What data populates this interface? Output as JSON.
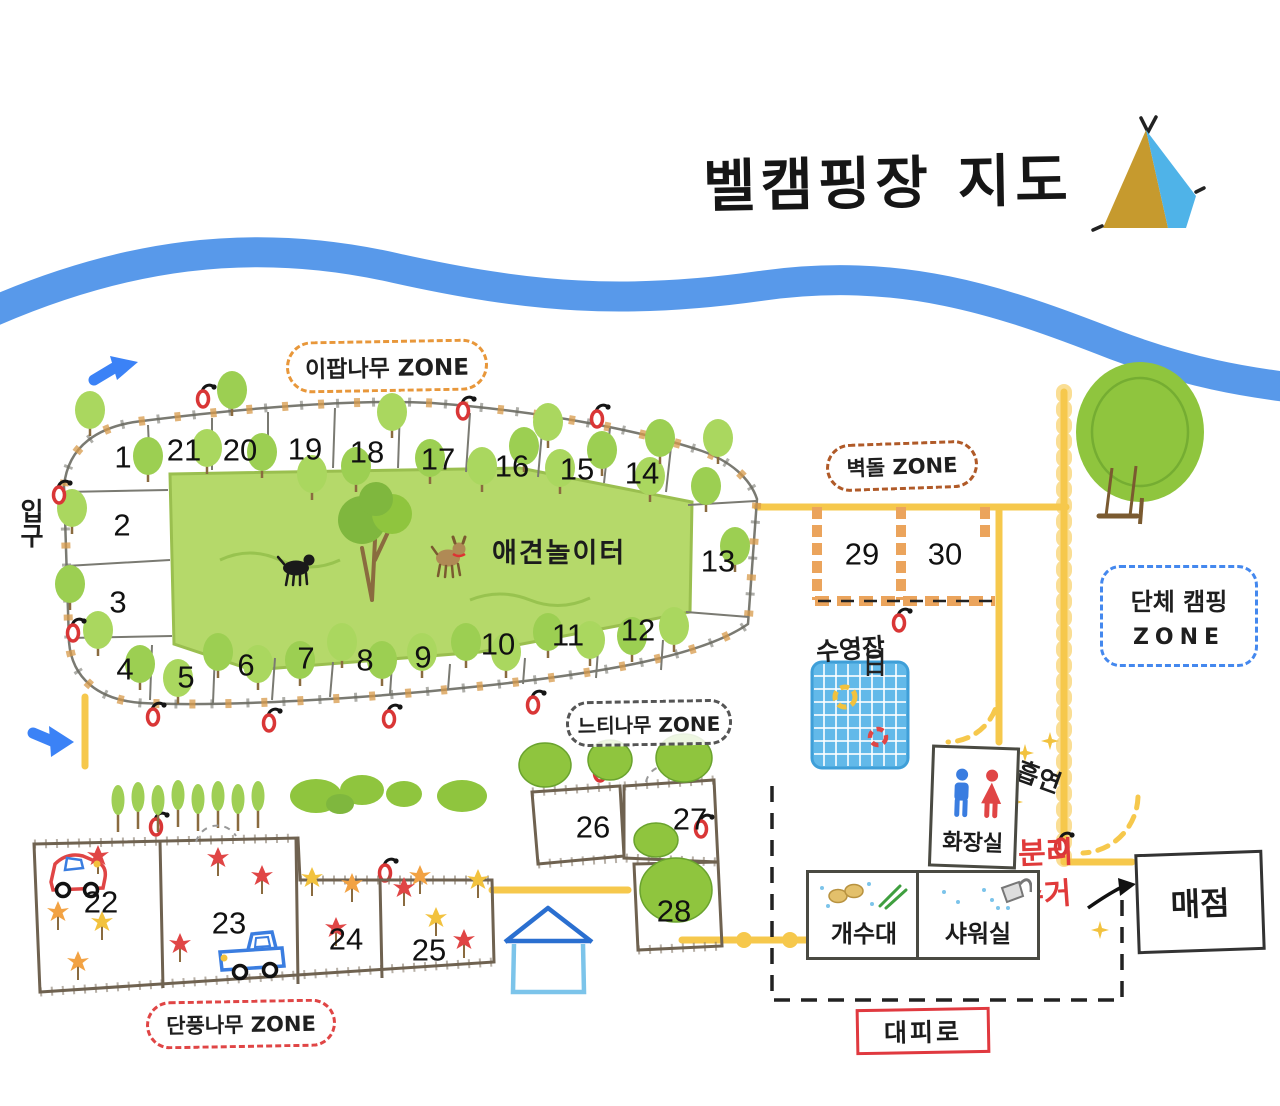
{
  "title": "벨캠핑장 지도",
  "zones": {
    "ipap": "이팝나무 ZONE",
    "brick": "벽돌 ZONE",
    "zelkova": "느티나무 ZONE",
    "maple": "단풍나무 ZONE",
    "group_line1": "단체 캠핑",
    "group_line2": "ZONE"
  },
  "labels": {
    "dog_playground": "애견놀이터",
    "pool": "수영장",
    "entrance": "입구",
    "restroom": "화장실",
    "smoking": "흡연",
    "recycling_line1": "분리",
    "recycling_line2": "수거",
    "sink": "개수대",
    "shower": "샤워실",
    "store": "매점",
    "evacuation_route": "대피로"
  },
  "sites": [
    "1",
    "2",
    "3",
    "4",
    "5",
    "6",
    "7",
    "8",
    "9",
    "10",
    "11",
    "12",
    "13",
    "14",
    "15",
    "16",
    "17",
    "18",
    "19",
    "20",
    "21",
    "22",
    "23",
    "24",
    "25",
    "26",
    "27",
    "28",
    "29",
    "30"
  ],
  "icons": {
    "tent": "tent-icon",
    "entrance_arrow": "entrance-arrow-icon",
    "street_lamp": "street-lamp-icon",
    "tree": "tree-icon",
    "maple_leaf": "maple-leaf-icon",
    "dog": "dog-icon",
    "swing_tree": "swing-tree-icon",
    "pool_ladder": "pool-ladder-icon",
    "swim_ring": "swim-ring-icon",
    "restroom_man": "restroom-man-icon",
    "restroom_woman": "restroom-woman-icon",
    "dishes": "dish-icon",
    "green_onion": "green-onion-icon",
    "shower_head": "shower-head-icon",
    "car": "car-icon",
    "truck": "truck-icon",
    "house": "house-icon",
    "sparkle": "sparkle-icon",
    "store_arrow": "arrow-to-store-icon"
  },
  "colors": {
    "river": "#4a90e8",
    "road": "#f6c84c",
    "grass": "#b5d96a",
    "tree_green": "#9fcf55",
    "pool_blue": "#62b9e9",
    "zone_ipap_border": "#e8973a",
    "zone_brick_border": "#b05a28",
    "zone_zelkova_border": "#555555",
    "zone_maple_border": "#e04545",
    "zone_group_border": "#4488ee",
    "recycling_text": "#e03a3a",
    "evacuation_border": "#e0393f",
    "lamp_red": "#d93636",
    "brick": "#eba45c"
  }
}
